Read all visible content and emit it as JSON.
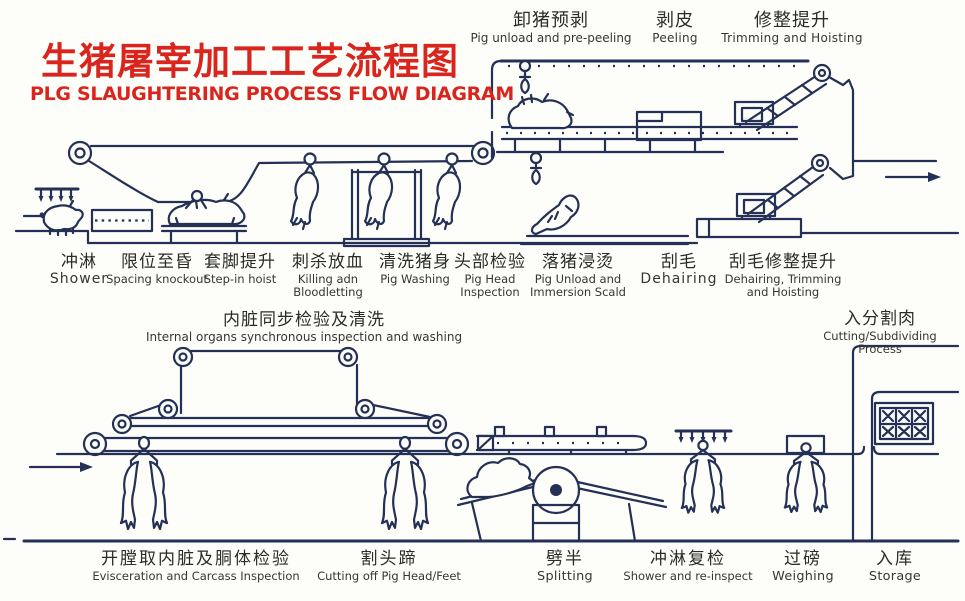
{
  "colors": {
    "ink": "#243055",
    "red": "#d9251d",
    "text": "#302f2b",
    "paper": "#fdfdf9"
  },
  "title": {
    "zh": "生猪屠宰加工工艺流程图",
    "en": "PLG SLAUGHTERING PROCESS FLOW DIAGRAM"
  },
  "top_row": [
    {
      "zh": "卸猪预剥",
      "en": "Pig unload and pre-peeling"
    },
    {
      "zh": "剥皮",
      "en": "Peeling"
    },
    {
      "zh": "修整提升",
      "en": "Trimming and Hoisting"
    }
  ],
  "mid_row": [
    {
      "zh": "冲淋",
      "en": "Shower"
    },
    {
      "zh": "限位至昏",
      "en": "Spacing knockout"
    },
    {
      "zh": "套脚提升",
      "en": "Step-in hoist"
    },
    {
      "zh": "刺杀放血",
      "en": "Killing adn\nBloodletting"
    },
    {
      "zh": "清洗猪身",
      "en": "Pig Washing"
    },
    {
      "zh": "头部检验",
      "en": "Pig Head\nInspection"
    },
    {
      "zh": "落猪浸烫",
      "en": "Pig Unload and\nImmersion Scald"
    },
    {
      "zh": "刮毛",
      "en": "Dehairing"
    },
    {
      "zh": "刮毛修整提升",
      "en": "Dehairing, Trimming\nand Hoisting"
    }
  ],
  "section_labels": [
    {
      "zh": "内脏同步检验及清洗",
      "en": "Internal organs synchronous inspection and washing"
    },
    {
      "zh": "入分割肉",
      "en": "Cutting/Subdividing Process"
    }
  ],
  "bottom_row": [
    {
      "zh": "开膛取内脏及胴体检验",
      "en": "Evisceration and Carcass Inspection"
    },
    {
      "zh": "割头蹄",
      "en": "Cutting off Pig Head/Feet"
    },
    {
      "zh": "劈半",
      "en": "Splitting"
    },
    {
      "zh": "冲淋复检",
      "en": "Shower and re-inspect"
    },
    {
      "zh": "过磅",
      "en": "Weighing"
    },
    {
      "zh": "入库",
      "en": "Storage"
    }
  ]
}
